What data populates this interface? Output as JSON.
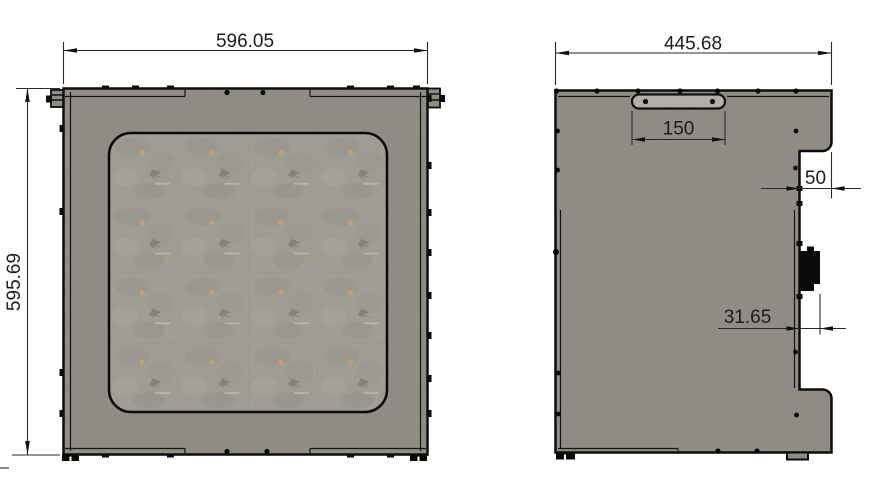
{
  "page": {
    "background": "#ffffff",
    "description": "Two-view technical drawing of sheet-metal enclosure panels"
  },
  "colors": {
    "panel": "#8f8c85",
    "window_base": "#9f9d95",
    "handle": "#b3b1a9",
    "speckle": "#c9a76b",
    "outline": "#0a0a0a",
    "dim_line": "#2a2a2a",
    "dim_text": "#1c1c1c"
  },
  "views": {
    "front": {
      "dims": {
        "width": "596.05",
        "height": "595.69"
      }
    },
    "side": {
      "dims": {
        "width": "445.68",
        "handle": "150",
        "notch": "50",
        "connector": "31.65"
      }
    }
  }
}
